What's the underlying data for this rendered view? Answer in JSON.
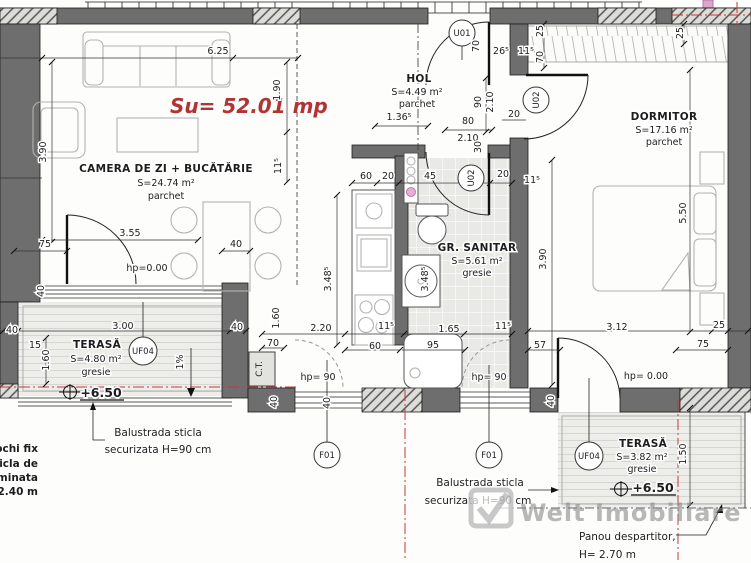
{
  "drawing": {
    "usable_area_label": "Su= 52.01 mp",
    "watermark": {
      "brand": "Welt Imobiliare"
    },
    "rooms": [
      {
        "id": "living",
        "name": "CAMERA DE ZI + BUCĂTĂRIE",
        "area": "S=24.74 m²",
        "floor": "parchet"
      },
      {
        "id": "hol",
        "name": "HOL",
        "area": "S=4.49 m²",
        "floor": "parchet"
      },
      {
        "id": "gr_sanitar",
        "name": "GR. SANITAR",
        "area": "S=5.61 m²",
        "floor": "gresie"
      },
      {
        "id": "dormitor",
        "name": "DORMITOR",
        "area": "S=17.16 m²",
        "floor": "parchet"
      },
      {
        "id": "terasa_1",
        "name": "TERASĂ",
        "area": "S=4.80 m²",
        "floor": "gresie"
      },
      {
        "id": "terasa_2",
        "name": "TERASĂ",
        "area": "S=3.82 m²",
        "floor": "gresie"
      }
    ],
    "levels": {
      "terasa_1": "+6.50",
      "terasa_2": "+6.50"
    },
    "tags": {
      "entrance_door": "U01",
      "hall_bedroom_door": "U02",
      "hall_bathroom_door": "U02",
      "terrace1_window": "UF04",
      "terrace2_window": "UF04",
      "window_left": "F01",
      "window_right": "F01",
      "boiler": "C.T."
    },
    "notes": {
      "balustrade_1": [
        "Balustrada sticla",
        "securizata H=90 cm"
      ],
      "balustrade_2": [
        "Balustrada sticla",
        "securizata H=90 cm"
      ],
      "partition": [
        "Panou despartitor,",
        "H= 2.70 m"
      ],
      "left_note": [
        "ochi fix",
        "icla de",
        "minata",
        "2.40 m"
      ]
    },
    "dimensions": [
      {
        "t": "6.25",
        "x": 218,
        "y": 54
      },
      {
        "t": "3.55",
        "x": 130,
        "y": 236
      },
      {
        "t": "75",
        "x": 45,
        "y": 247
      },
      {
        "t": "40",
        "x": 236,
        "y": 247
      },
      {
        "t": "hp=0.00",
        "x": 147,
        "y": 271
      },
      {
        "t": "1.36⁵",
        "x": 399,
        "y": 120
      },
      {
        "t": "80",
        "x": 468,
        "y": 124
      },
      {
        "t": "2.10",
        "x": 468,
        "y": 141
      },
      {
        "t": "20",
        "x": 514,
        "y": 117
      },
      {
        "t": "26⁵",
        "x": 501,
        "y": 54
      },
      {
        "t": "11⁵",
        "x": 526,
        "y": 54
      },
      {
        "t": "60",
        "x": 366,
        "y": 179
      },
      {
        "t": "20",
        "x": 388,
        "y": 179
      },
      {
        "t": "45",
        "x": 430,
        "y": 179
      },
      {
        "t": "20",
        "x": 503,
        "y": 177
      },
      {
        "t": "11⁵",
        "x": 532,
        "y": 183
      },
      {
        "t": "40",
        "x": 12,
        "y": 333
      },
      {
        "t": "3.00",
        "x": 123,
        "y": 329
      },
      {
        "t": "40",
        "x": 237,
        "y": 330
      },
      {
        "t": "15",
        "x": 35,
        "y": 348
      },
      {
        "t": "2.20",
        "x": 321,
        "y": 331
      },
      {
        "t": "11⁵",
        "x": 386,
        "y": 329
      },
      {
        "t": "1.65",
        "x": 449,
        "y": 332
      },
      {
        "t": "11⁵",
        "x": 503,
        "y": 329
      },
      {
        "t": "70",
        "x": 273,
        "y": 346
      },
      {
        "t": "60",
        "x": 375,
        "y": 349
      },
      {
        "t": "95",
        "x": 433,
        "y": 348
      },
      {
        "t": "57",
        "x": 540,
        "y": 348
      },
      {
        "t": "3.12",
        "x": 617,
        "y": 330
      },
      {
        "t": "25",
        "x": 719,
        "y": 328
      },
      {
        "t": "75",
        "x": 703,
        "y": 347
      },
      {
        "t": "hp= 90",
        "x": 318,
        "y": 380
      },
      {
        "t": "hp= 90",
        "x": 489,
        "y": 380
      },
      {
        "t": "hp= 0.00",
        "x": 646,
        "y": 379
      },
      {
        "t": "3.90",
        "x": 46,
        "y": 152,
        "r": 1
      },
      {
        "t": "1.90",
        "x": 280,
        "y": 90,
        "r": 1
      },
      {
        "t": "11⁵",
        "x": 281,
        "y": 166,
        "r": 1
      },
      {
        "t": "90",
        "x": 481,
        "y": 102,
        "r": 1
      },
      {
        "t": "2.10",
        "x": 493,
        "y": 102,
        "r": 1
      },
      {
        "t": "30",
        "x": 481,
        "y": 147,
        "r": 1
      },
      {
        "t": "70",
        "x": 479,
        "y": 46,
        "r": 1
      },
      {
        "t": "25",
        "x": 543,
        "y": 31,
        "r": 1
      },
      {
        "t": "70",
        "x": 543,
        "y": 57,
        "r": 1
      },
      {
        "t": "25",
        "x": 683,
        "y": 33,
        "r": 1
      },
      {
        "t": "1.60",
        "x": 49,
        "y": 360,
        "r": 1
      },
      {
        "t": "40",
        "x": 44,
        "y": 291,
        "r": 1
      },
      {
        "t": "1.60",
        "x": 279,
        "y": 318,
        "r": 1
      },
      {
        "t": "3.48⁵",
        "x": 331,
        "y": 279,
        "r": 1
      },
      {
        "t": "3.48⁵",
        "x": 428,
        "y": 279,
        "r": 1
      },
      {
        "t": "3.90",
        "x": 546,
        "y": 259,
        "r": 1
      },
      {
        "t": "5.50",
        "x": 686,
        "y": 213,
        "r": 1
      },
      {
        "t": "1.50",
        "x": 686,
        "y": 454,
        "r": 1
      },
      {
        "t": "40",
        "x": 277,
        "y": 402,
        "r": 1
      },
      {
        "t": "40",
        "x": 330,
        "y": 403,
        "r": 1
      },
      {
        "t": "40",
        "x": 554,
        "y": 401,
        "r": 1
      },
      {
        "t": "1%",
        "x": 183,
        "y": 362,
        "r": 1
      }
    ],
    "colors": {
      "wall": "#6e6e6e",
      "accent_red": "#b03434",
      "centerline_red": "#c23a3a",
      "tile": "#e9e9e6",
      "watermark": "#8a8a8a"
    }
  }
}
